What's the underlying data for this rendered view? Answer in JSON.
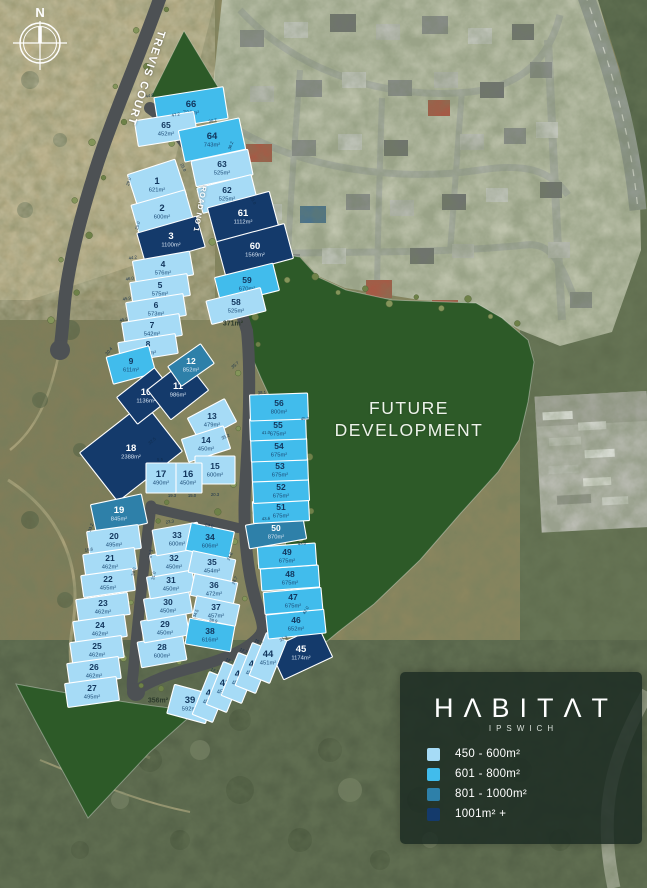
{
  "map": {
    "labels": {
      "trevis_court": "TREVIS COURT",
      "road_no_1": "ROAD NO 1",
      "green_371": "371m²",
      "green_356": "356m²"
    },
    "future_development": {
      "line1": "FUTURE",
      "line2": "DEVELOPMENT"
    },
    "compass": {
      "label": "N"
    },
    "lots_format": [
      "number",
      "area",
      "category",
      "cx",
      "cy",
      "w",
      "h",
      "rotate"
    ],
    "lots": [
      [
        66,
        "726m²",
        2,
        191,
        108,
        70,
        32,
        -9
      ],
      [
        65,
        "452m²",
        1,
        166,
        129,
        60,
        26,
        -9
      ],
      [
        64,
        "743m²",
        2,
        212,
        140,
        62,
        32,
        -12
      ],
      [
        63,
        "525m²",
        1,
        222,
        168,
        58,
        26,
        -12
      ],
      [
        62,
        "525m²",
        1,
        227,
        194,
        56,
        26,
        -14
      ],
      [
        61,
        "1112m²",
        4,
        243,
        217,
        64,
        36,
        -15
      ],
      [
        60,
        "1569m²",
        4,
        255,
        250,
        70,
        36,
        -15
      ],
      [
        59,
        "670m²",
        2,
        247,
        284,
        60,
        28,
        -14
      ],
      [
        58,
        "525m²",
        1,
        236,
        306,
        56,
        24,
        -14
      ],
      [
        1,
        "621m²",
        1,
        157,
        185,
        50,
        38,
        -18
      ],
      [
        2,
        "600m²",
        1,
        162,
        212,
        56,
        30,
        -16
      ],
      [
        3,
        "1100m²",
        4,
        171,
        240,
        62,
        32,
        -16
      ],
      [
        4,
        "576m²",
        1,
        163,
        268,
        58,
        24,
        -10
      ],
      [
        5,
        "575m²",
        1,
        160,
        289,
        58,
        22,
        -9
      ],
      [
        6,
        "573m²",
        1,
        156,
        309,
        58,
        22,
        -9
      ],
      [
        7,
        "542m²",
        1,
        152,
        329,
        58,
        22,
        -9
      ],
      [
        8,
        "453m²",
        1,
        148,
        348,
        58,
        20,
        -9
      ],
      [
        9,
        "611m²",
        2,
        131,
        365,
        44,
        28,
        -15
      ],
      [
        18,
        "2388m²",
        4,
        131,
        452,
        82,
        62,
        -38
      ],
      [
        10,
        "1136m²",
        4,
        146,
        396,
        48,
        34,
        -38
      ],
      [
        11,
        "986m²",
        4,
        178,
        390,
        48,
        38,
        -38
      ],
      [
        12,
        "852m²",
        3,
        191,
        365,
        40,
        24,
        -35
      ],
      [
        13,
        "479m²",
        1,
        212,
        420,
        42,
        26,
        -28
      ],
      [
        14,
        "450m²",
        1,
        206,
        444,
        44,
        24,
        -18
      ],
      [
        15,
        "600m²",
        1,
        215,
        470,
        40,
        28,
        0
      ],
      [
        16,
        "450m²",
        1,
        188,
        478,
        28,
        30,
        0
      ],
      [
        17,
        "490m²",
        1,
        161,
        478,
        30,
        30,
        0
      ],
      [
        19,
        "845m²",
        3,
        119,
        514,
        52,
        30,
        -12
      ],
      [
        20,
        "495m²",
        1,
        114,
        540,
        52,
        24,
        -8
      ],
      [
        21,
        "462m²",
        1,
        110,
        562,
        52,
        22,
        -8
      ],
      [
        22,
        "455m²",
        1,
        108,
        583,
        52,
        22,
        -8
      ],
      [
        23,
        "462m²",
        1,
        103,
        607,
        52,
        22,
        -8
      ],
      [
        24,
        "462m²",
        1,
        100,
        629,
        52,
        22,
        -8
      ],
      [
        25,
        "462m²",
        1,
        97,
        650,
        52,
        22,
        -8
      ],
      [
        26,
        "462m²",
        1,
        94,
        671,
        52,
        22,
        -8
      ],
      [
        27,
        "495m²",
        1,
        92,
        692,
        52,
        24,
        -8
      ],
      [
        28,
        "600m²",
        1,
        162,
        651,
        46,
        26,
        -10
      ],
      [
        29,
        "450m²",
        1,
        165,
        628,
        46,
        22,
        -10
      ],
      [
        30,
        "450m²",
        1,
        168,
        606,
        46,
        22,
        -10
      ],
      [
        31,
        "450m²",
        1,
        171,
        584,
        46,
        22,
        -10
      ],
      [
        32,
        "450m²",
        1,
        174,
        562,
        46,
        22,
        -10
      ],
      [
        33,
        "600m²",
        1,
        177,
        539,
        46,
        26,
        -10
      ],
      [
        34,
        "606m²",
        2,
        210,
        541,
        44,
        28,
        12
      ],
      [
        35,
        "454m²",
        1,
        212,
        566,
        44,
        22,
        12
      ],
      [
        36,
        "472m²",
        1,
        214,
        589,
        44,
        22,
        12
      ],
      [
        37,
        "457m²",
        1,
        216,
        611,
        44,
        22,
        12
      ],
      [
        38,
        "616m²",
        2,
        210,
        635,
        46,
        26,
        10
      ],
      [
        39,
        "592m²",
        1,
        190,
        704,
        40,
        30,
        15
      ],
      [
        45,
        "1174m²",
        4,
        301,
        653,
        54,
        34,
        -25
      ],
      [
        40,
        "451m²",
        1,
        211,
        697,
        22,
        46,
        22
      ],
      [
        41,
        "451m²",
        1,
        225,
        687,
        22,
        46,
        22
      ],
      [
        42,
        "451m²",
        1,
        240,
        678,
        22,
        46,
        22
      ],
      [
        43,
        "451m²",
        1,
        254,
        668,
        22,
        46,
        22
      ],
      [
        44,
        "451m²",
        1,
        268,
        658,
        22,
        46,
        22
      ],
      [
        46,
        "652m²",
        2,
        296,
        624,
        58,
        24,
        -6
      ],
      [
        47,
        "675m²",
        2,
        293,
        601,
        58,
        22,
        -5
      ],
      [
        48,
        "675m²",
        2,
        290,
        578,
        58,
        22,
        -4
      ],
      [
        49,
        "675m²",
        2,
        287,
        556,
        58,
        22,
        -4
      ],
      [
        50,
        "870m²",
        3,
        276,
        532,
        58,
        24,
        -10
      ],
      [
        51,
        "675m²",
        2,
        281,
        511,
        56,
        22,
        -3
      ],
      [
        52,
        "675m²",
        2,
        281,
        491,
        56,
        22,
        -3
      ],
      [
        53,
        "675m²",
        2,
        280,
        470,
        56,
        22,
        -2
      ],
      [
        54,
        "675m²",
        2,
        279,
        450,
        56,
        22,
        -2
      ],
      [
        55,
        "675m²",
        2,
        278,
        429,
        56,
        22,
        -2
      ],
      [
        56,
        "800m²",
        2,
        279,
        407,
        58,
        26,
        -2
      ]
    ],
    "dimensions_format": [
      "text",
      "x",
      "y",
      "rotate"
    ],
    "dimensions": [
      [
        "44.6",
        150,
        97,
        -12
      ],
      [
        "47.2",
        176,
        116,
        -12
      ],
      [
        "30.7",
        213,
        122,
        -12
      ],
      [
        "36.2",
        232,
        146,
        -70
      ],
      [
        "25.0",
        182,
        168,
        65
      ],
      [
        "35.0",
        252,
        201,
        65
      ],
      [
        "29.0",
        130,
        182,
        -75
      ],
      [
        "25.0",
        139,
        226,
        -75
      ],
      [
        "38.1",
        262,
        394,
        -5
      ],
      [
        "45.0",
        305,
        420,
        -3
      ],
      [
        "43.0",
        302,
        545,
        -4
      ],
      [
        "42.0",
        307,
        611,
        -60
      ],
      [
        "12.7",
        214,
        672,
        25
      ],
      [
        "12.7",
        229,
        662,
        25
      ],
      [
        "12.7",
        243,
        652,
        25
      ],
      [
        "10.7",
        258,
        643,
        25
      ],
      [
        "34.5",
        197,
        614,
        -65
      ],
      [
        "24.8",
        231,
        557,
        -65
      ],
      [
        "26.7",
        236,
        581,
        -65
      ],
      [
        "38.9",
        213,
        622,
        12
      ],
      [
        "23.0",
        209,
        527,
        12
      ],
      [
        "23.3",
        170,
        523,
        -8
      ],
      [
        "27.3",
        152,
        554,
        -78
      ],
      [
        "31.0",
        155,
        576,
        -78
      ],
      [
        "45.8",
        124,
        321,
        -10
      ],
      [
        "45.9",
        127,
        300,
        -10
      ],
      [
        "46.0",
        130,
        280,
        -10
      ],
      [
        "44.2",
        133,
        259,
        -10
      ],
      [
        "30.4",
        110,
        352,
        -50
      ],
      [
        "33.2",
        92,
        528,
        -70
      ],
      [
        "34.0",
        135,
        572,
        -78
      ],
      [
        "15.6",
        89,
        551,
        -8
      ],
      [
        "35.2",
        226,
        438,
        -25
      ],
      [
        "5.5",
        160,
        461,
        0
      ],
      [
        "19.3",
        172,
        497,
        0
      ],
      [
        "15.0",
        192,
        497,
        0
      ],
      [
        "20.3",
        215,
        496,
        0
      ],
      [
        "32.5",
        153,
        442,
        -40
      ],
      [
        "35.7",
        236,
        366,
        -40
      ],
      [
        "35.3",
        284,
        640,
        -25
      ],
      [
        "43.6",
        266,
        520,
        -3
      ],
      [
        "41.0",
        266,
        434,
        -3
      ]
    ]
  },
  "legend": {
    "logo": "HΛBITΛT",
    "sub": "IPSWICH",
    "items": [
      {
        "label": "450 - 600m²",
        "color": "#A6DBF6"
      },
      {
        "label": "601 - 800m²",
        "color": "#41BCEC"
      },
      {
        "label": "801 - 1000m²",
        "color": "#2E80A9"
      },
      {
        "label": "1001m² +",
        "color": "#143A6B"
      }
    ]
  },
  "colors": {
    "future_development_green": "#2d5a28",
    "road": "#4d5154",
    "lot_border": "#ffffff",
    "lot_text_dark": "#12365d",
    "lot_text_light": "#ffffff"
  }
}
